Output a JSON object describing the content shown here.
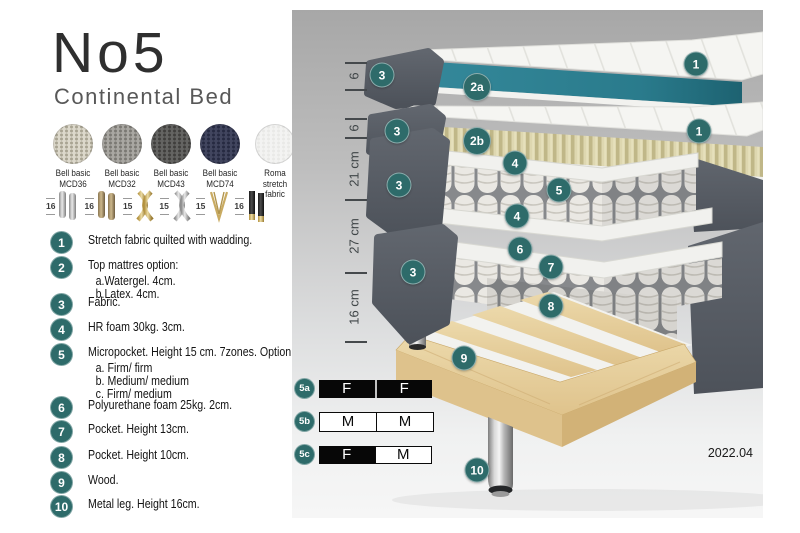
{
  "title": "No5",
  "subtitle": "Continental Bed",
  "swatches": [
    {
      "line1": "Bell basic",
      "line2": "MCD36",
      "color": "#dcd8cb",
      "dot": "#a9a493"
    },
    {
      "line1": "Bell basic",
      "line2": "MCD32",
      "color": "#a9a7a2",
      "dot": "#7b7974"
    },
    {
      "line1": "Bell basic",
      "line2": "MCD43",
      "color": "#646462",
      "dot": "#403f3d"
    },
    {
      "line1": "Bell basic",
      "line2": "MCD74",
      "color": "#41455e",
      "dot": "#262a41"
    },
    {
      "line1": "Roma",
      "line2": "stretch fabric",
      "color": "#f3f3f2",
      "dot": "#e9e9e7"
    }
  ],
  "legs": [
    {
      "height": "16",
      "style": "chrome-cylinder"
    },
    {
      "height": "16",
      "style": "bronze-cylinder"
    },
    {
      "height": "15",
      "style": "gold-twist"
    },
    {
      "height": "15",
      "style": "silver-twist"
    },
    {
      "height": "15",
      "style": "gold-hairpin"
    },
    {
      "height": "16",
      "style": "black-gold"
    }
  ],
  "list": {
    "items": [
      {
        "num": "1",
        "text": "Stretch fabric quilted with wadding."
      },
      {
        "num": "2",
        "text": "Top mattres option:",
        "sub": [
          "a.Watergel. 4cm.",
          "b.Latex. 4cm."
        ]
      },
      {
        "num": "3",
        "text": "Fabric."
      },
      {
        "num": "4",
        "text": "HR foam 30kg. 3cm."
      },
      {
        "num": "5",
        "text": "Micropocket. Height 15 cm. 7zones. Option:",
        "sub": [
          "a. Firm/ firm",
          "b. Medium/ medium",
          "c. Firm/ medium"
        ]
      },
      {
        "num": "6",
        "text": "Polyurethane foam 25kg. 2cm."
      },
      {
        "num": "7",
        "text": "Pocket. Height 13cm."
      },
      {
        "num": "8",
        "text": "Pocket. Height 10cm."
      },
      {
        "num": "9",
        "text": "Wood."
      },
      {
        "num": "10",
        "text": "Metal leg. Height 16cm."
      }
    ]
  },
  "diagram": {
    "badge_color": "#2e6b6a",
    "dimensions": [
      "6",
      "6",
      "21 cm",
      "27 cm",
      "16 cm"
    ],
    "badges": [
      "3",
      "2a",
      "1",
      "3",
      "2b",
      "1",
      "4",
      "5",
      "3",
      "4",
      "6",
      "7",
      "3",
      "8",
      "9",
      "10"
    ]
  },
  "firmness": {
    "rows": [
      {
        "badge": "5a",
        "cells": [
          {
            "t": "F"
          },
          {
            "t": "F"
          }
        ]
      },
      {
        "badge": "5b",
        "cells": [
          {
            "t": "M"
          },
          {
            "t": "M"
          }
        ]
      },
      {
        "badge": "5c",
        "cells": [
          {
            "t": "F"
          },
          {
            "t": "M"
          }
        ]
      }
    ]
  },
  "footer": {
    "version": "2022.04"
  }
}
